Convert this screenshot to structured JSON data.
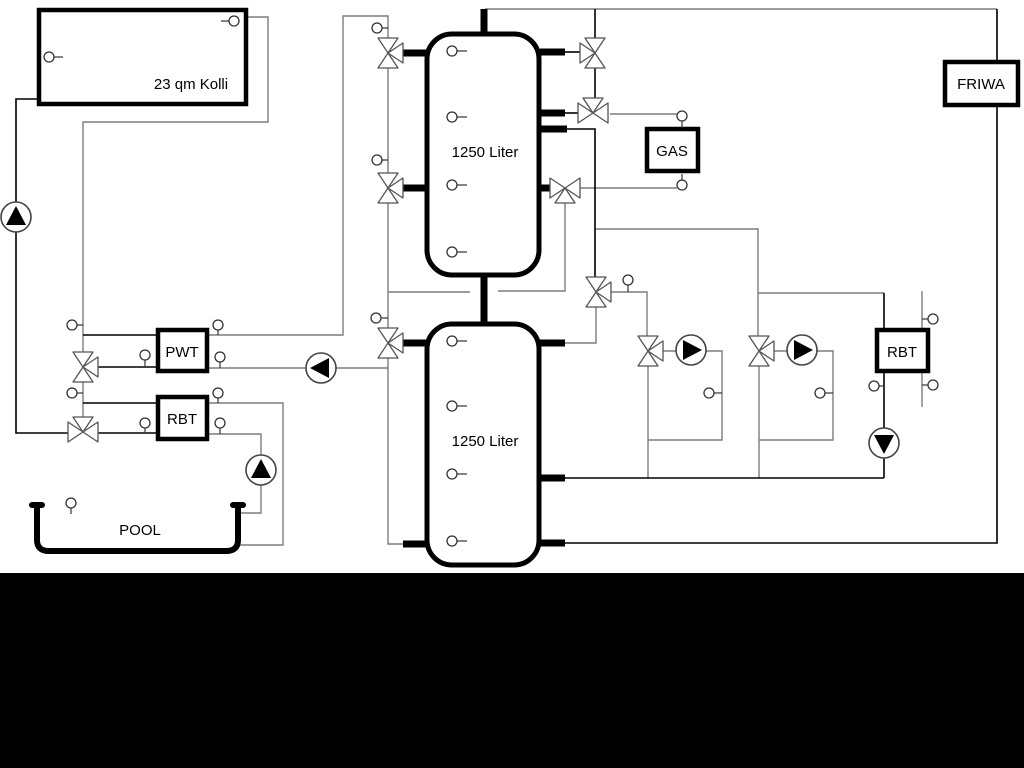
{
  "diagram": {
    "labels": {
      "collector": "23 qm Kolli",
      "buffer_tank_top": "1250 Liter",
      "buffer_tank_bottom": "1250 Liter",
      "gas_boiler": "GAS",
      "friwa": "FRIWA",
      "pwt": "PWT",
      "rbt_left": "RBT",
      "rbt_right": "RBT",
      "pool": "POOL"
    },
    "colors": {
      "background": "#ffffff",
      "letterbox": "#000000",
      "pipe_gray": "#7d7d7d",
      "pipe_black": "#000000"
    },
    "components": {
      "pumps": [
        {
          "name": "solar-pump",
          "direction": "up"
        },
        {
          "name": "pwt-charge-pump",
          "direction": "left"
        },
        {
          "name": "pool-pump",
          "direction": "up"
        },
        {
          "name": "heating-circuit-1-pump",
          "direction": "right"
        },
        {
          "name": "heating-circuit-2-pump",
          "direction": "right"
        },
        {
          "name": "rbt-return-pump",
          "direction": "down"
        }
      ],
      "three_way_valves": 11,
      "temperature_sensors": 25
    }
  }
}
